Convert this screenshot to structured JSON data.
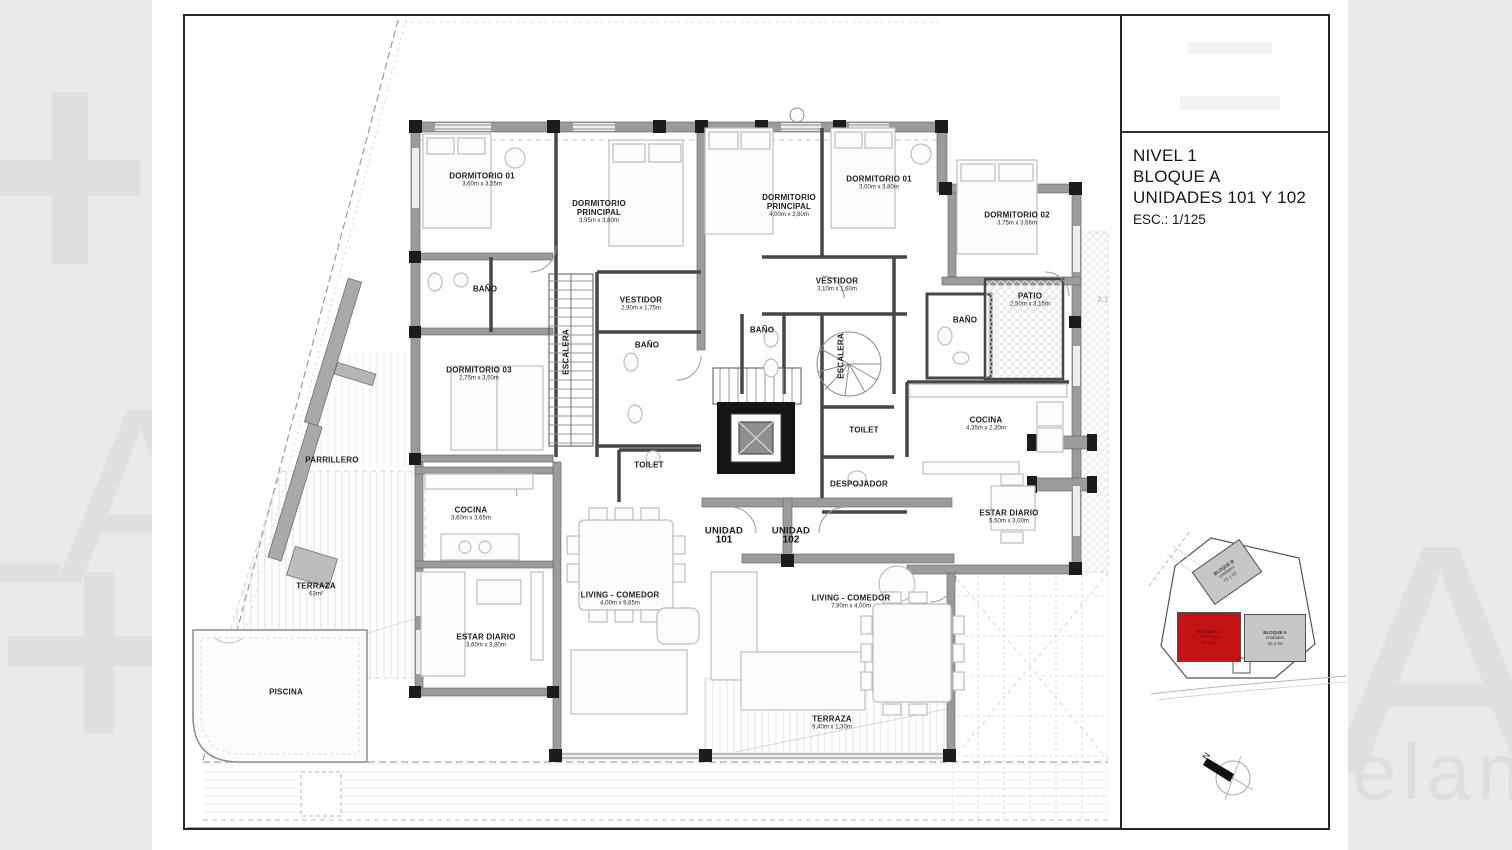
{
  "title_block": {
    "line1": "NIVEL 1",
    "line2": "BLOQUE A",
    "line3": "UNIDADES 101 Y 102",
    "scale": "ESC.: 1/125"
  },
  "watermarks": {
    "left_letters": "LA",
    "right_letter": "A",
    "bottom_right": "elan"
  },
  "north_label": "N",
  "plan": {
    "rooms": [
      {
        "label": "DORMITORIO 01",
        "dims": "3,60m x 3,55m",
        "x": 297,
        "y": 164
      },
      {
        "label": "DORMITORIO PRINCIPAL",
        "dims": "3,95m x 3,80m",
        "x": 414,
        "y": 196,
        "cls": "narrow"
      },
      {
        "label": "DORMITORIO PRINCIPAL",
        "dims": "4,00m x 3,80m",
        "x": 604,
        "y": 190,
        "cls": "narrow"
      },
      {
        "label": "DORMITORIO 01",
        "dims": "3,00m x 3,80m",
        "x": 694,
        "y": 167
      },
      {
        "label": "DORMITORIO 02",
        "dims": "3,75m x 3,66m",
        "x": 832,
        "y": 203
      },
      {
        "label": "BAÑO",
        "x": 300,
        "y": 273
      },
      {
        "label": "VESTIDOR",
        "dims": "2,90m x 1,75m",
        "x": 456,
        "y": 288
      },
      {
        "label": "VESTIDOR",
        "dims": "3,10m x 1,60m",
        "x": 652,
        "y": 269
      },
      {
        "label": "BAÑO",
        "x": 462,
        "y": 329
      },
      {
        "label": "BAÑO",
        "x": 577,
        "y": 314
      },
      {
        "label": "BAÑO",
        "x": 780,
        "y": 304
      },
      {
        "label": "PATIO",
        "dims": "2,50m x 3,15m",
        "x": 845,
        "y": 284
      },
      {
        "label": "ESCALERA",
        "x": 381,
        "y": 336,
        "cls": "rot90"
      },
      {
        "label": "ESCALERA",
        "x": 656,
        "y": 340,
        "cls": "rot90"
      },
      {
        "label": "DORMITORIO 03",
        "dims": "2,75m x 3,50m",
        "x": 294,
        "y": 358
      },
      {
        "label": "TOILET",
        "x": 464,
        "y": 449
      },
      {
        "label": "TOILET",
        "x": 679,
        "y": 414
      },
      {
        "label": "DESPOJADOR",
        "x": 674,
        "y": 468
      },
      {
        "label": "COCINA",
        "dims": "4,35m x 2,30m",
        "x": 801,
        "y": 408
      },
      {
        "label": "PARRILLERO",
        "x": 147,
        "y": 444
      },
      {
        "label": "COCINA",
        "dims": "3,60m x 3,65m",
        "x": 286,
        "y": 498
      },
      {
        "label": "ESTAR DIARIO",
        "dims": "5,50m x 3,00m",
        "x": 824,
        "y": 501
      },
      {
        "label": "TERRAZA",
        "dims": "63m²",
        "x": 131,
        "y": 574
      },
      {
        "label": "LIVING - COMEDOR",
        "dims": "4,00m x 9,65m",
        "x": 435,
        "y": 583
      },
      {
        "label": "ESTAR DIARIO",
        "dims": "3,60m x 3,80m",
        "x": 301,
        "y": 625
      },
      {
        "label": "LIVING - COMEDOR",
        "dims": "7,90m x 4,00m",
        "x": 666,
        "y": 586
      },
      {
        "label": "PISCINA",
        "x": 101,
        "y": 676
      },
      {
        "label": "TERRAZA",
        "dims": "9,40m x 1,30m",
        "x": 647,
        "y": 707
      },
      {
        "label": "UNIDAD",
        "dims": "101",
        "x": 539,
        "y": 519,
        "cls": "unit"
      },
      {
        "label": "UNIDAD",
        "dims": "102",
        "x": 606,
        "y": 519,
        "cls": "unit"
      },
      {
        "label": "2,1",
        "x": 918,
        "y": 284,
        "cls": "faint"
      }
    ]
  },
  "key_map": {
    "highlight_color": "#c21414",
    "block_fill": "#c7c7c7",
    "blocks": [
      {
        "name": "BLOQUE B",
        "sub": "unidades",
        "units": "01 y 02",
        "x": 80,
        "y": 48,
        "w": 58,
        "h": 40,
        "rot": -35,
        "highlight": false
      },
      {
        "name": "BLOQUE A",
        "sub": "unidades",
        "units": "01 y 02",
        "x": 62,
        "y": 113,
        "w": 64,
        "h": 50,
        "rot": 0,
        "highlight": true
      },
      {
        "name": "BLOQUE A",
        "sub": "unidades",
        "units": "03 y 04",
        "x": 128,
        "y": 114,
        "w": 62,
        "h": 48,
        "rot": 0,
        "highlight": false
      }
    ]
  }
}
